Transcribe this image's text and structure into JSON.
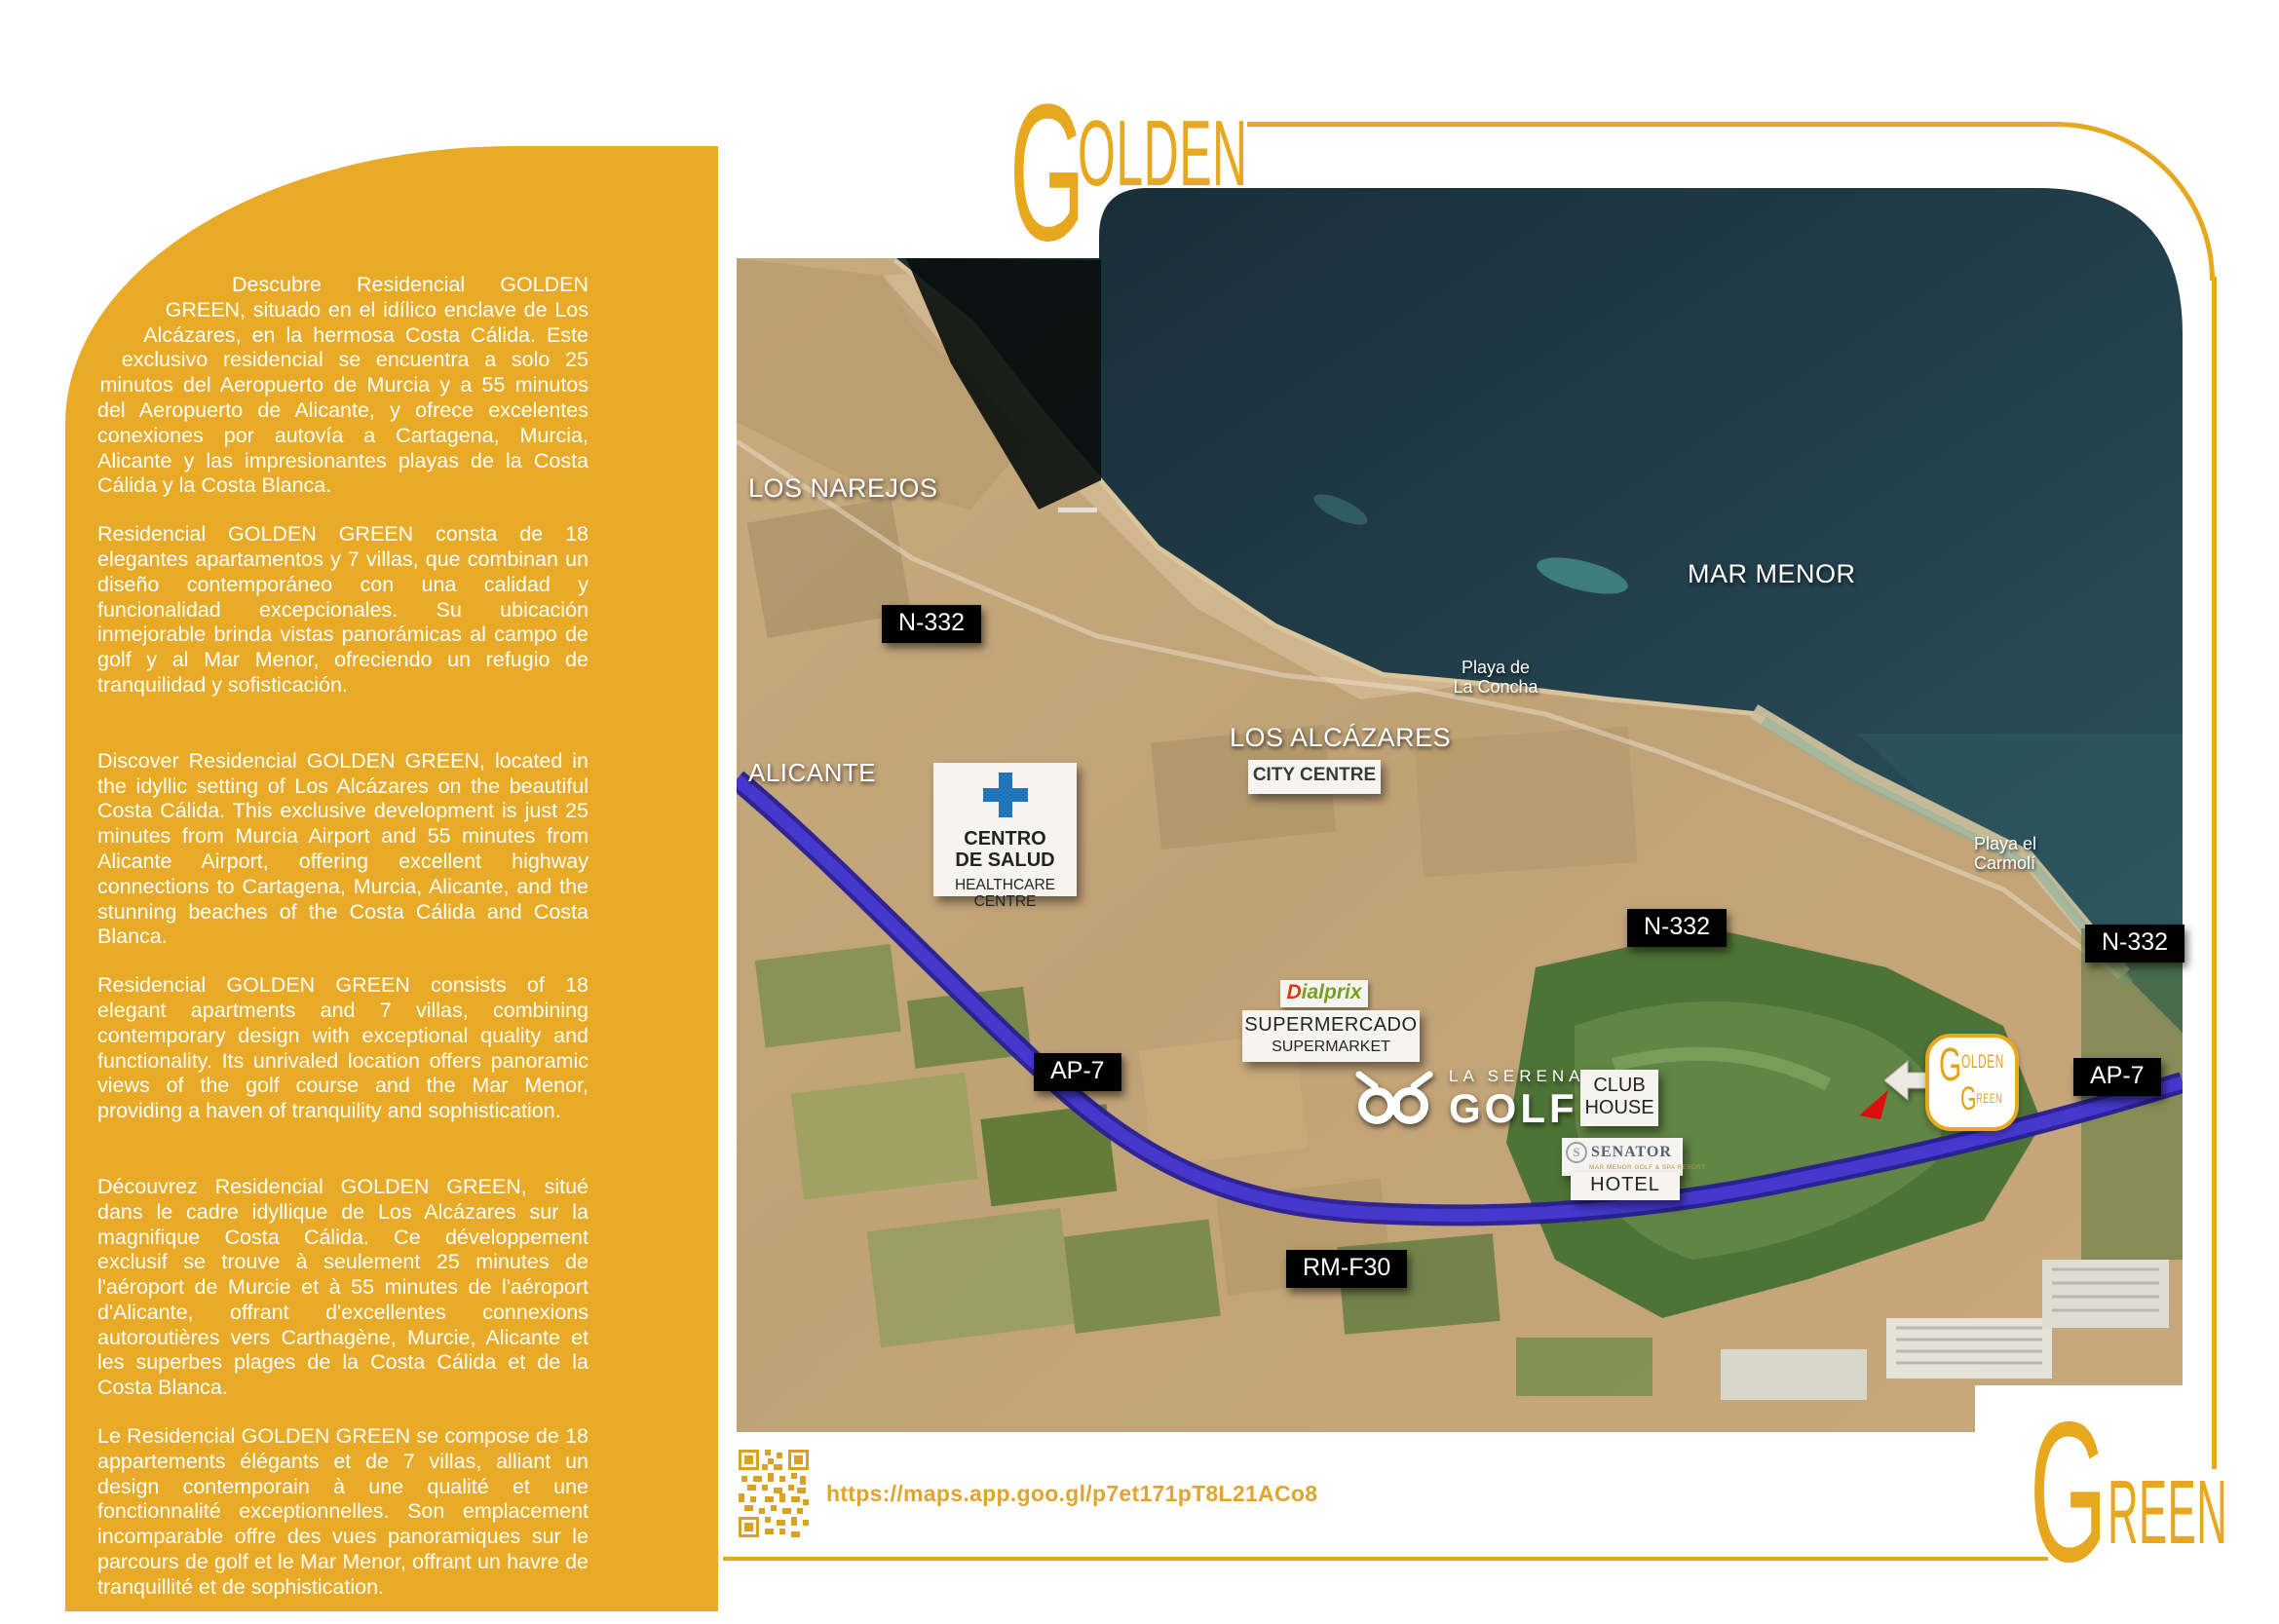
{
  "brand": {
    "golden_initial": "G",
    "golden_rest": "OLDEN",
    "green_initial": "G",
    "green_rest": "REEN"
  },
  "sidebar": {
    "paragraphs": [
      {
        "lang": "es",
        "text": "Descubre Residencial GOLDEN GREEN, situado en el idílico enclave de Los Alcázares, en la hermosa Costa Cálida. Este exclusivo residencial se encuentra a solo 25 minutos del Aeropuerto de Murcia y a 55 minutos del Aeropuerto de Alicante, y ofrece excelentes conexiones por autovía a Cartagena, Murcia, Alicante y las impresionantes playas de la Costa Cálida y la Costa Blanca."
      },
      {
        "lang": "es",
        "text": "Residencial GOLDEN GREEN consta de 18 elegantes apartamentos y 7 villas, que combinan un diseño contemporáneo con una calidad y funcionalidad excepcionales. Su ubicación inmejorable brinda vistas panorámicas al campo de golf y al Mar Menor, ofreciendo un refugio de tranquilidad y sofisticación."
      },
      {
        "lang": "en",
        "text": "Discover Residencial GOLDEN GREEN, located in the idyllic setting of Los Alcázares on the beautiful Costa Cálida. This exclusive development is just 25 minutes from Murcia Airport and 55 minutes from Alicante Airport, offering excellent highway connections to Cartagena, Murcia, Alicante, and the stunning beaches of the Costa Cálida and Costa Blanca."
      },
      {
        "lang": "en",
        "text": "Residencial GOLDEN GREEN consists of 18 elegant apartments and 7 villas, combining contemporary design with exceptional quality and functionality. Its unrivaled location offers panoramic views of the golf course and the Mar Menor, providing a haven of tranquility and sophistication."
      },
      {
        "lang": "fr",
        "text": "Découvrez Residencial GOLDEN GREEN, situé dans le cadre idyllique de Los Alcázares sur la magnifique Costa Cálida. Ce développement exclusif se trouve à seulement 25 minutes de l'aéroport de Murcie et à 55 minutes de l'aéroport d'Alicante, offrant d'excellentes connexions autoroutières vers Carthagène, Murcie, Alicante et les superbes plages de la Costa Cálida et de la Costa Blanca."
      },
      {
        "lang": "fr",
        "text": "Le Residencial GOLDEN GREEN se compose de 18 appartements élégants et de 7 villas, alliant un design contemporain à une qualité et une fonctionnalité exceptionnelles. Son emplacement incomparable offre des vues panoramiques sur le parcours de golf et le Mar Menor, offrant un havre de tranquillité et de sophistication."
      }
    ]
  },
  "map": {
    "towns": {
      "los_narejos": "LOS NAREJOS",
      "alicante": "ALICANTE",
      "los_alcazares": "LOS ALCÁZARES",
      "mar_menor": "MAR MENOR"
    },
    "beaches": {
      "la_concha_1": "Playa de",
      "la_concha_2": "La Concha",
      "carmoli_1": "Playa el",
      "carmoli_2": "Carmolí"
    },
    "roads": {
      "n332": "N-332",
      "ap7": "AP-7",
      "rmf30": "RM-F30"
    },
    "poi": {
      "healthcare": {
        "title1": "CENTRO",
        "title2": "DE SALUD",
        "sub1": "HEALTHCARE",
        "sub2": "CENTRE"
      },
      "city_centre": "CITY CENTRE",
      "dialprix_d": "D",
      "dialprix_rest": "ialprix",
      "supermarket": {
        "line1": "SUPERMERCADO",
        "line2": "SUPERMARKET"
      },
      "golf": {
        "line1": "LA SERENA",
        "line2": "GOLF"
      },
      "club_house": {
        "line1": "CLUB",
        "line2": "HOUSE"
      },
      "senator": {
        "name": "SENATOR",
        "subtitle": "MAR MENOR GOLF & SPA RESORT",
        "hotel": "HOTEL"
      },
      "marker": {
        "golden_initial": "G",
        "golden_rest": "OLDEN",
        "green_initial": "G",
        "green_rest": "REEN"
      }
    }
  },
  "footer": {
    "url": "https://maps.app.goo.gl/p7et171pT8L21ACo8"
  },
  "colors": {
    "gold": "#e7a71f",
    "sidebar_yellow": "#e9ab27",
    "sea_navy": "#22404c",
    "highway_blue": "#4638cd"
  }
}
